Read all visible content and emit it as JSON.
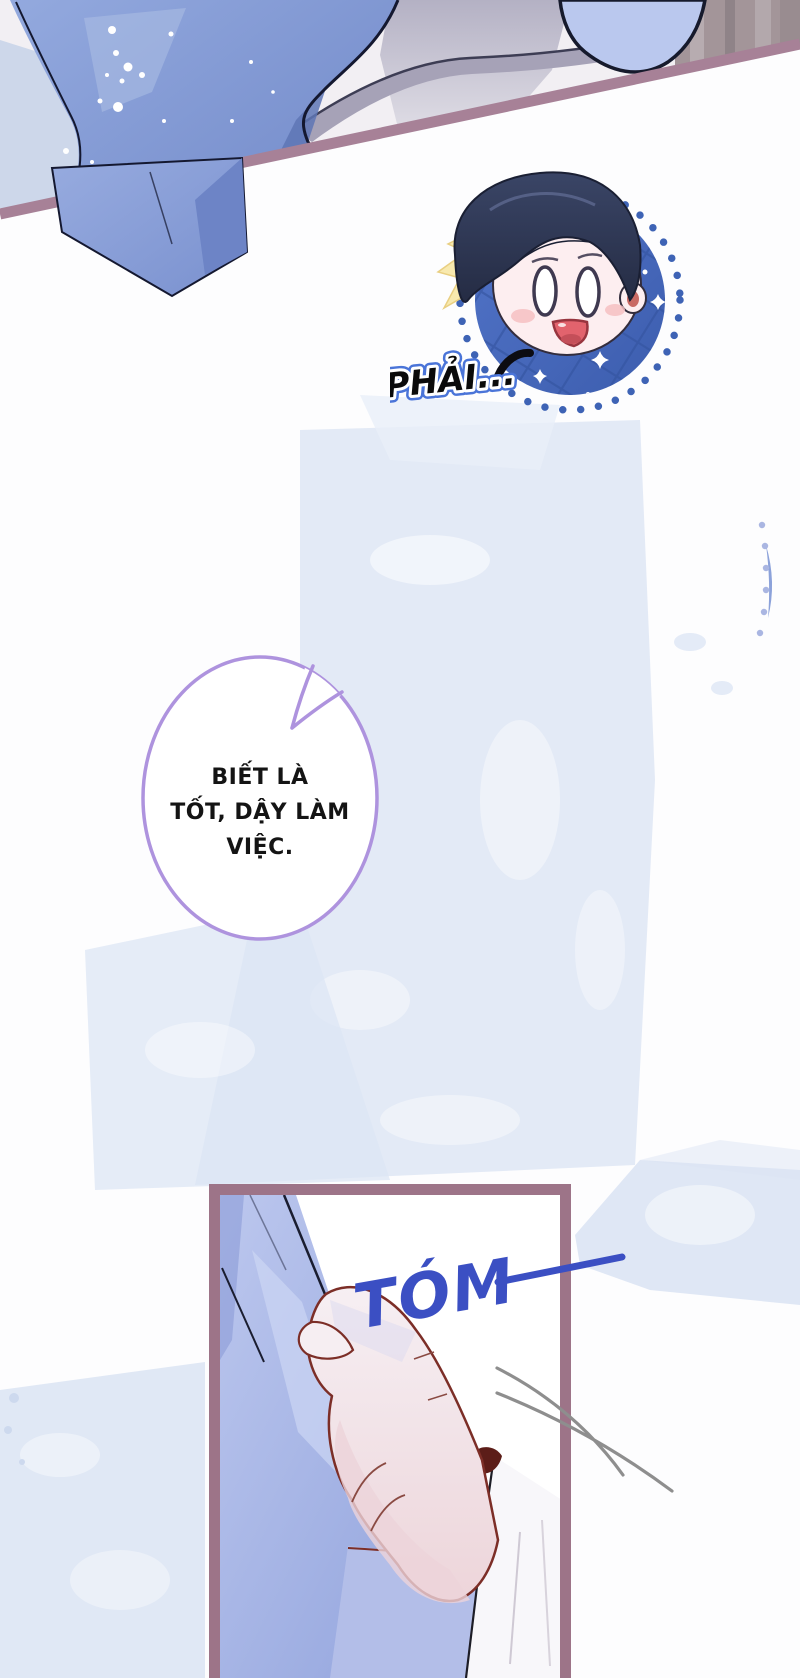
{
  "comic": {
    "sticker_caption": "PHẢI...",
    "bubble_lines": [
      "BIẾT LÀ",
      "TỐT, DẬY LÀM",
      "VIỆC."
    ],
    "sfx_grab": "TÓM"
  },
  "colors": {
    "page_bg": "#fdfdfe",
    "wash_blue": "#dce5f4",
    "divider_line": "#a78197",
    "panel_border": "#9d7488",
    "sfx_blue": "#3b4fc3",
    "bubble_outline": "#ae93de",
    "caption_fill": "#0a0a0a",
    "caption_inner_stroke": "#ffffff",
    "caption_outer_stroke": "#4a74d8",
    "sticker_circle_blue": "#4a6cc0",
    "jacket_blue": "#8099d4",
    "motion_line_gray": "#8e8e8e"
  }
}
